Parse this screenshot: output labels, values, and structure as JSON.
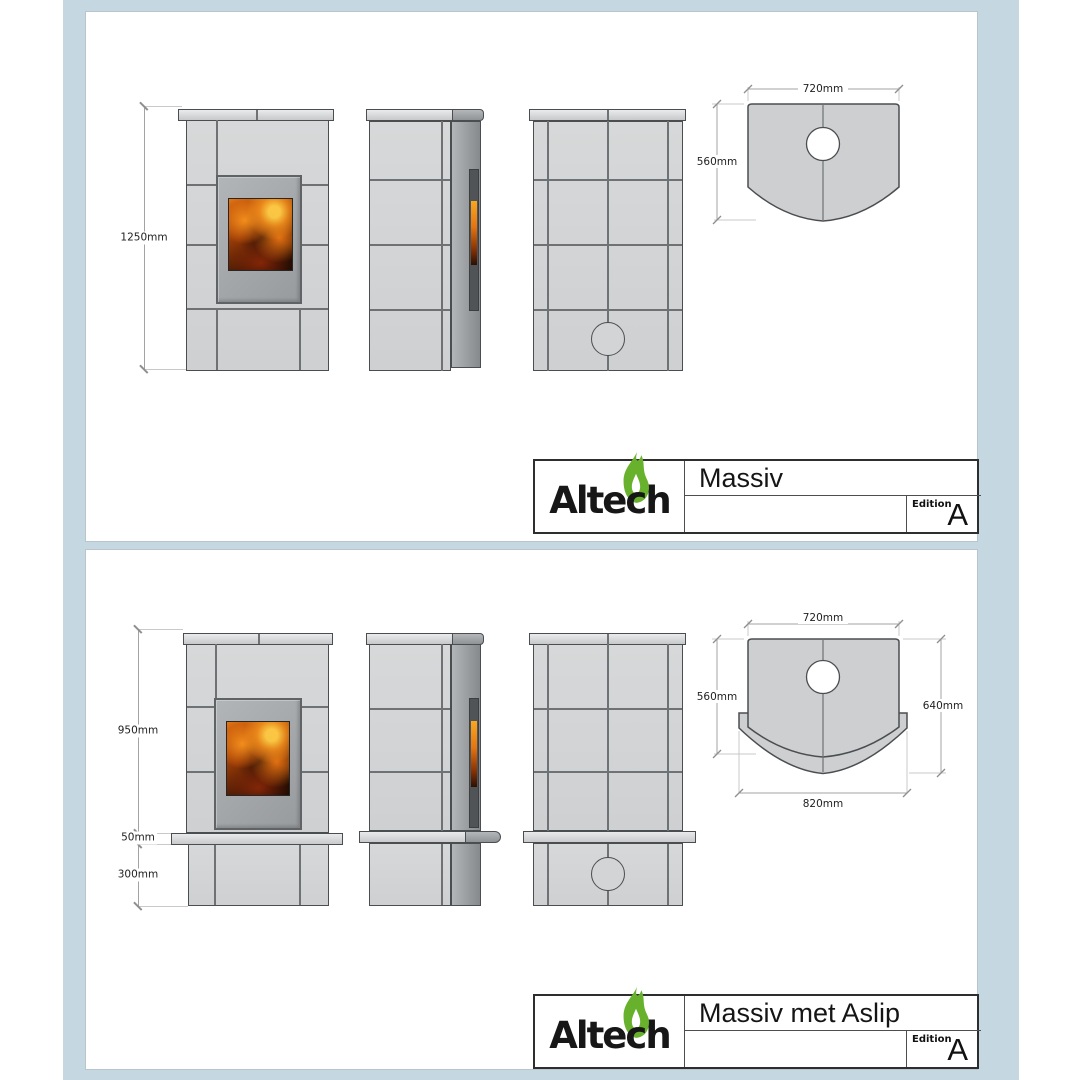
{
  "logo": {
    "part1": "Alte",
    "part2": "c",
    "part3": "h"
  },
  "colors": {
    "background_blue": "#c5d7e0",
    "sheet_white": "#ffffff",
    "tile_grey": "#d2d3d4",
    "outline_grey": "#4b4e50",
    "logo_green": "#68b12c",
    "fire_orange": "#e07713"
  },
  "sheet1": {
    "title": "Massiv",
    "edition_label": "Edition",
    "edition_value": "A",
    "front_height": "1250mm",
    "top_width": "720mm",
    "top_depth": "560mm"
  },
  "sheet2": {
    "title": "Massiv met Aslip",
    "edition_label": "Edition",
    "edition_value": "A",
    "body_height": "950mm",
    "shelf_height": "50mm",
    "base_height": "300mm",
    "top_width": "720mm",
    "top_depth": "560mm",
    "shelf_depth": "640mm",
    "shelf_width": "820mm"
  }
}
